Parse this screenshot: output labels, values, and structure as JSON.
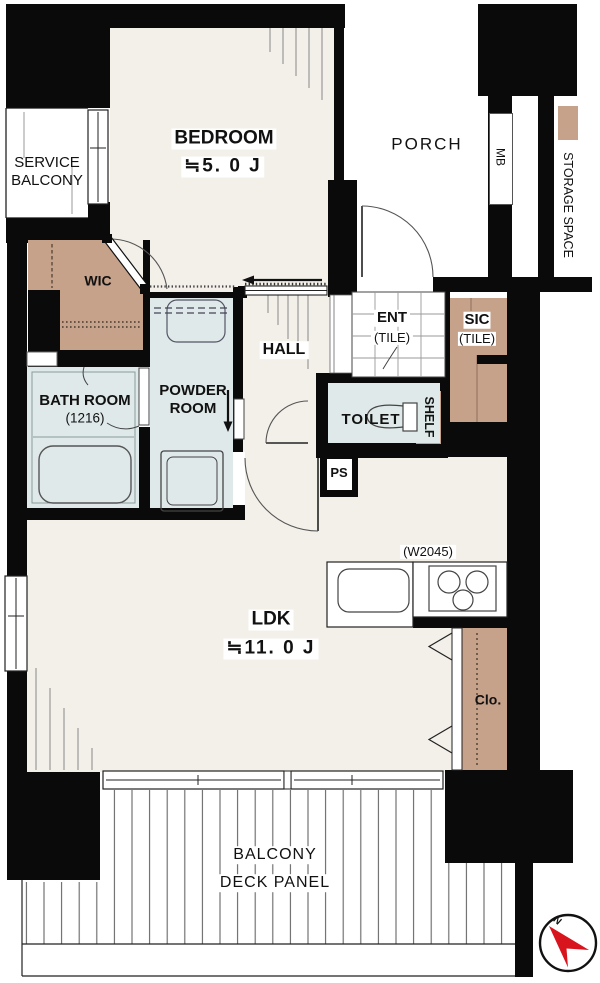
{
  "colors": {
    "wall": "#0a0a0a",
    "floor_beige": "#f3f0e9",
    "wet_room_blue": "#dfe9e9",
    "storage_tan": "#c7a28b",
    "compass_red": "#d8141d"
  },
  "labels": {
    "service_balcony_1": "SERVICE",
    "service_balcony_2": "BALCONY",
    "bedroom_name": "BEDROOM",
    "bedroom_size": "≒5. 0 J",
    "porch": "PORCH",
    "mb": "MB",
    "storage_space": "STORAGE SPACE",
    "wic": "WIC",
    "hall": "HALL",
    "ent_name": "ENT",
    "ent_sub": "(TILE)",
    "sic_name": "SIC",
    "sic_sub": "(TILE)",
    "toilet": "TOILET",
    "shelf": "SHELF",
    "ps": "PS",
    "bathroom_name": "BATH ROOM",
    "bathroom_size": "(1216)",
    "powder_1": "POWDER",
    "powder_2": "ROOM",
    "ldk_name": "LDK",
    "ldk_size": "≒11. 0 J",
    "kitchen_width": "(W2045)",
    "closet": "Clo.",
    "balcony_1": "BALCONY",
    "balcony_2": "DECK PANEL",
    "compass_north": "N"
  }
}
